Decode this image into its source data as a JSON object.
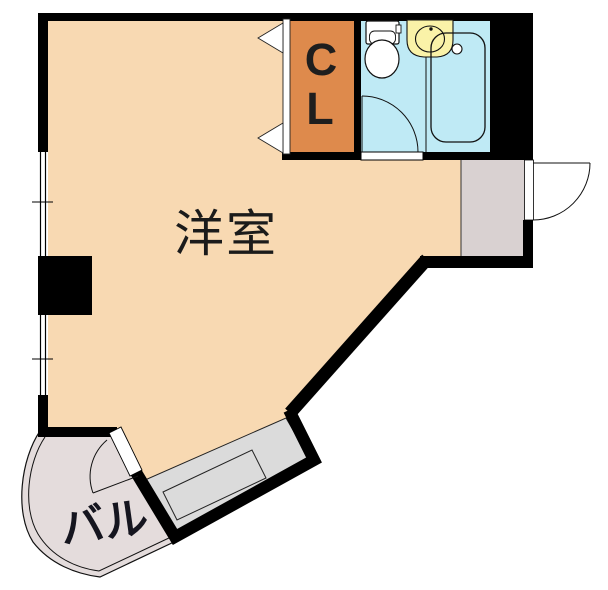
{
  "floorplan": {
    "type": "apartment-room-layout",
    "rooms": {
      "main_room_label": "洋室",
      "closet_label_c": "C",
      "closet_label_l": "L",
      "balcony_label": "バル"
    },
    "fixtures": [
      "toilet",
      "wash-basin",
      "bathtub",
      "kitchen-counter",
      "closet-folding-doors",
      "entry-door",
      "bathroom-door",
      "balcony-door",
      "window",
      "window"
    ],
    "colors": {
      "wall": "#000000",
      "main_room_fill": "#F8D9B2",
      "closet_fill": "#DE8A4C",
      "bathroom_fill": "#BFEAF5",
      "basin_fill": "#FAF2A8",
      "entry_fill": "#D9D1D1",
      "balcony_fill": "#E4DCDC",
      "counter_fill": "#DBDBDB",
      "fixture_fill": "#FFFFFF",
      "line": "#111111"
    }
  }
}
